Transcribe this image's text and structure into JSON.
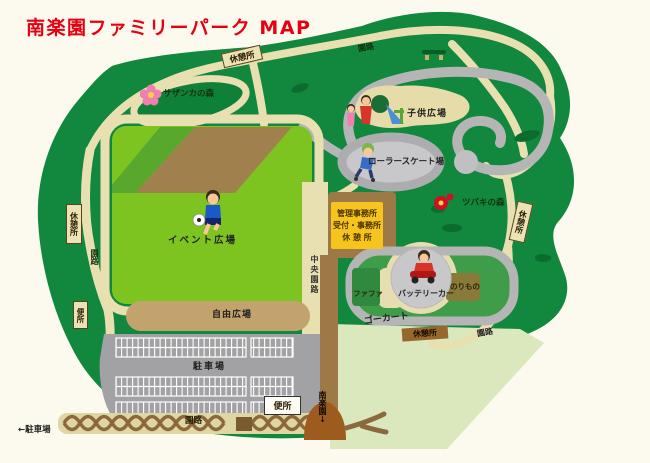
{
  "title": "南楽園ファミリーパーク MAP",
  "labels": {
    "rest_top": "休憩所",
    "enro_top": "園路",
    "sazanka": "サザンカの森",
    "kodomo": "子供広場",
    "roller": "ローラースケート場",
    "tsubaki": "ツバキの森",
    "rest_right": "休憩所",
    "office_line1": "管理事務所",
    "office_line2": "受付・事務所",
    "office_line3": "休 憩 所",
    "event": "イベント広場",
    "rest_left": "休憩所",
    "enro_left": "園路",
    "chuo_enro": "中央園路",
    "benjo_left": "便所",
    "jiyu": "自由広場",
    "fafa": "ファファ",
    "battery": "バッテリーカー",
    "norimono": "のりもの",
    "gokart": "ゴーカート",
    "rest_kart": "休憩所",
    "enro_kart": "園路",
    "parking": "駐車場",
    "benjo_bottom": "便所",
    "enro_bottom": "園路",
    "parking_arrow": "←駐車場",
    "nanrakuen": "南楽園↓"
  },
  "icons": {
    "sazanka_flower": "pink-camellia-flower",
    "tsubaki_flower": "red-camellia-flower",
    "soccer_boy": "boy-kicking-soccer-ball",
    "kids_playground": "children-with-slide",
    "roller_skater": "roller-skater",
    "battery_car_rider": "child-on-battery-car",
    "picnic_bench": "picnic-bench"
  },
  "colors": {
    "title_red": "#e60012",
    "park_green": "#12873e",
    "field_green": "#7dc421",
    "path_tan": "#e9e0b2",
    "road_gray": "#b5b5b6",
    "office_yellow": "#f6c41c",
    "pale_green": "#dbe7bd",
    "dirt_brown": "#a0814d",
    "parking_gray": "#a2a2a4",
    "background_cream": "#fcfaee"
  }
}
